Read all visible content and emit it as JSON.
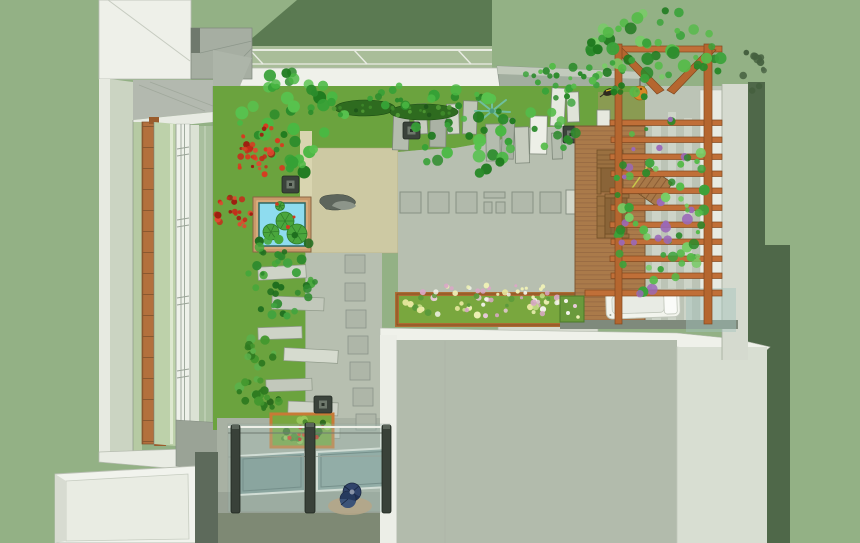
{
  "scene": {
    "title": "Top-down 3D rendering of a courtyard roof garden",
    "style": "sketchup-axonometric-render",
    "objects": [
      "surrounding-building-walls",
      "window-facade-with-wood-mullion",
      "glass-canopy",
      "lawn",
      "green-tree-canopies",
      "red-shrubs",
      "lily-pond",
      "stone-lanterns",
      "standing-stone-slabs",
      "stepping-stone-path",
      "paver-row",
      "flower-planter-box",
      "wooden-pergola-with-vines",
      "timber-deck",
      "wooden-armchairs",
      "slatted-table",
      "white-daybed",
      "glass-balustrade",
      "skylight-panes",
      "spiral-staircase",
      "berry-planter",
      "lower-roof-block"
    ],
    "counts": {
      "pergola_beams": 11,
      "balustrade_posts": 3,
      "stone_lanterns": 4,
      "lily_pads": 4,
      "paver_squares": 7,
      "stepping_stones": 7
    }
  },
  "palette": {
    "background": "#93b185",
    "roof_dark": "#5b7a52",
    "shadow_dark": "#4f6849",
    "wall_white": "#eff1ea",
    "wall_gray": "#a6aea2",
    "canopy_glass": "#a9bd99",
    "lawn": "#6ba33e",
    "lawn_olive": "#8a9b52",
    "khaki_terrace": "#cdc9a3",
    "paving": "#b7bfb0",
    "stone": "#b4bcae",
    "stone_light": "#d3d8cc",
    "window_wood": "#b3703d",
    "pergola_wood": "#c06f38",
    "deck_wood": "#aa7a4a",
    "pond_frame": "#c99a6b",
    "pond_water": "#8edcef",
    "lily_pad": "#4aa63d",
    "planter_green": "#79a73e",
    "planter_frame": "#ad6c33",
    "blossom_cream": "#eef0b6",
    "blossom_pink": "#d9a8c6",
    "glass_tint": "#a5c3bc",
    "skylight_glass": "#7d9792",
    "post_dark": "#394139",
    "stair_blue": "#31446b",
    "foliage_green": "#36a136",
    "foliage_red": "#c8291a",
    "berry_red": "#cc2217",
    "walkway": "#99a295",
    "block_gray": "#b2bbac",
    "block_light": "#d8ded2"
  }
}
